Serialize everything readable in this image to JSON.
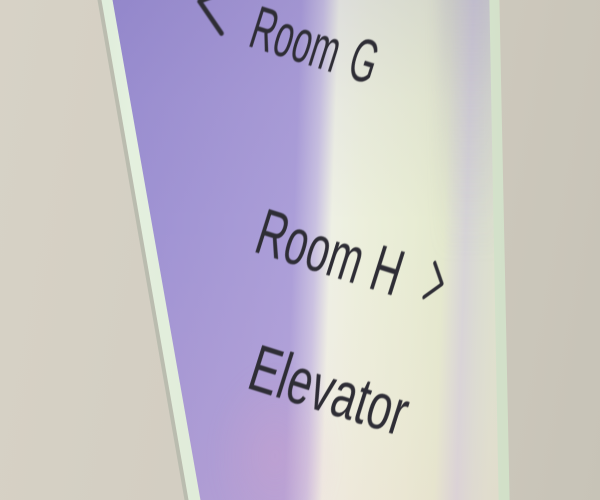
{
  "scene": {
    "description": "Photograph of an iridescent acrylic wayfinding sign mounted on a beige wall, viewed at an angle",
    "colors": {
      "wall": "#d2cdc1",
      "sign_purple": "#a89bd5",
      "sign_pale_green": "#e8ecd4",
      "sign_highlight": "#eef0e4",
      "glass_edge_mint": "#d9e9d6",
      "lilac_sheen": "#aca4c3",
      "text": "#2e2d35"
    }
  },
  "sign": {
    "rows": [
      {
        "label": "Room G",
        "chevron": "left",
        "chevron_icon": "chevron-left-icon"
      },
      {
        "label": "Room H",
        "chevron": "right",
        "chevron_icon": "chevron-right-icon"
      },
      {
        "label": "Elevator",
        "chevron": null
      }
    ]
  }
}
